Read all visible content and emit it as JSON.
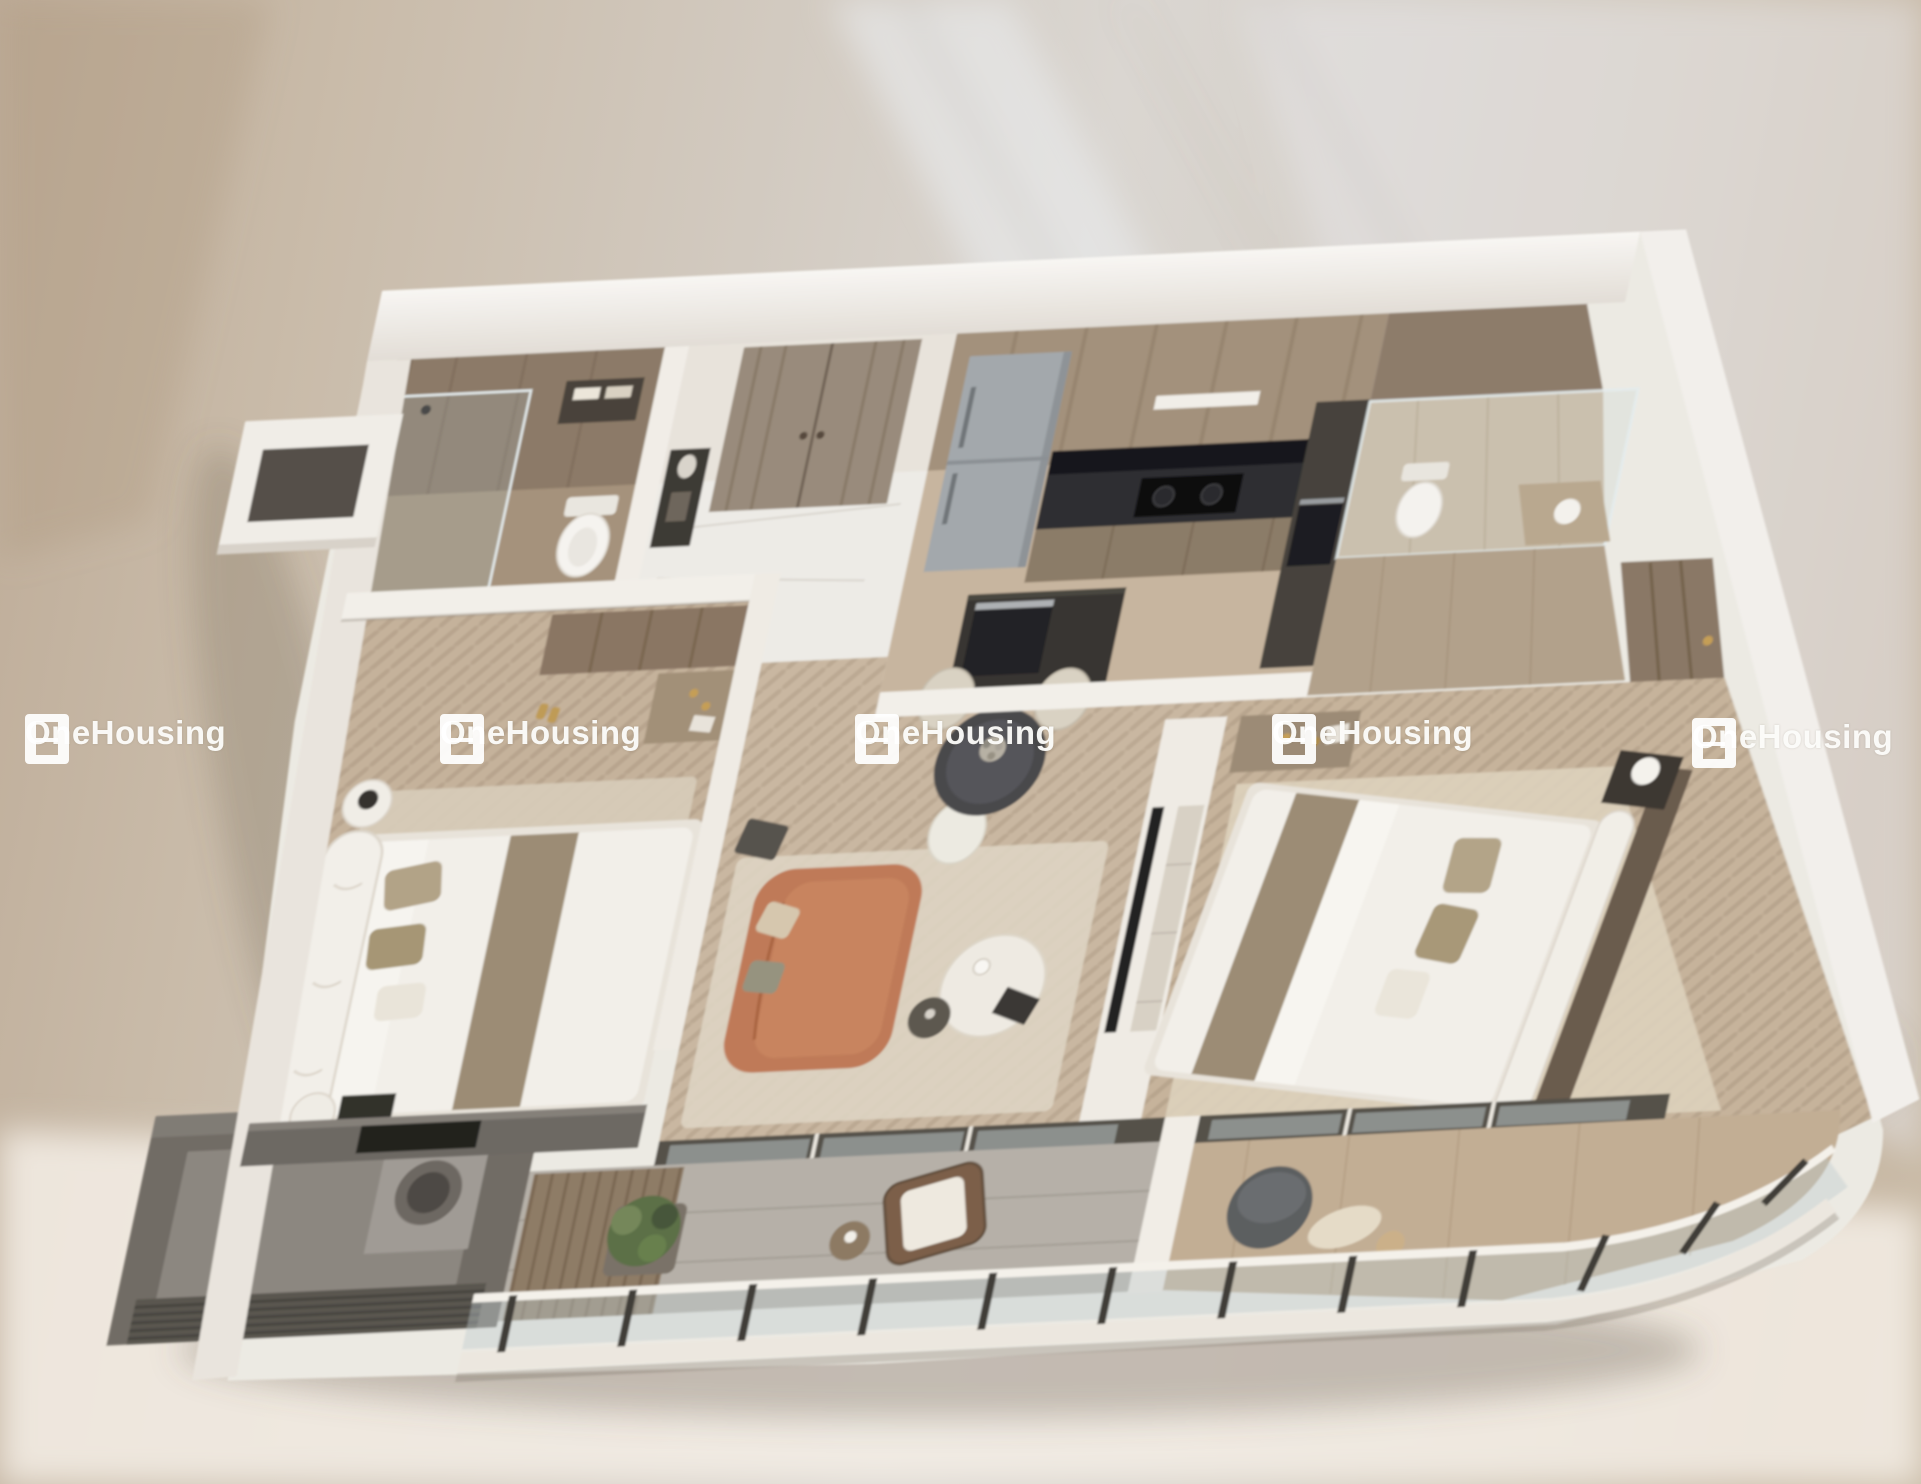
{
  "brand": {
    "name": "OneHousing"
  },
  "watermarks": {
    "count": 5,
    "items": [
      {
        "label": "OneHousing"
      },
      {
        "label": "OneHousing"
      },
      {
        "label": "OneHousing"
      },
      {
        "label": "OneHousing"
      },
      {
        "label": "OneHousing"
      }
    ]
  },
  "scene": {
    "type": "3d-apartment-floorplan-render",
    "view": "isometric-top-down",
    "rooms": [
      "bathroom-1",
      "entry-hall",
      "kitchen",
      "bathroom-2",
      "closet-corridor",
      "bedroom-1",
      "living-dining-room",
      "master-bedroom",
      "utility-room",
      "balcony",
      "master-balcony"
    ],
    "furniture": [
      "double-bed",
      "master-bed",
      "terracotta-sofa",
      "coffee-table",
      "dining-table",
      "dining-chairs",
      "fridge",
      "kitchen-island",
      "cooktop",
      "toilet",
      "glass-shower",
      "vanity",
      "washing-machine",
      "wardrobe",
      "tv-console",
      "nightstands",
      "lounge-chair",
      "pouf",
      "potted-plant",
      "glass-railing"
    ]
  },
  "colors": {
    "backdrop": "#cfc5b6",
    "walls": "#f2efe9",
    "dark_wall": "#6d6963",
    "wood_floor": "#c8b6a0",
    "marble_floor": "#edebe6",
    "bath_tile": "#a5927c",
    "counter": "#2f2f32",
    "sofa": "#bf7a58",
    "glass": "#cfd9db",
    "plant": "#5c7046",
    "watermark": "#ffffff"
  }
}
